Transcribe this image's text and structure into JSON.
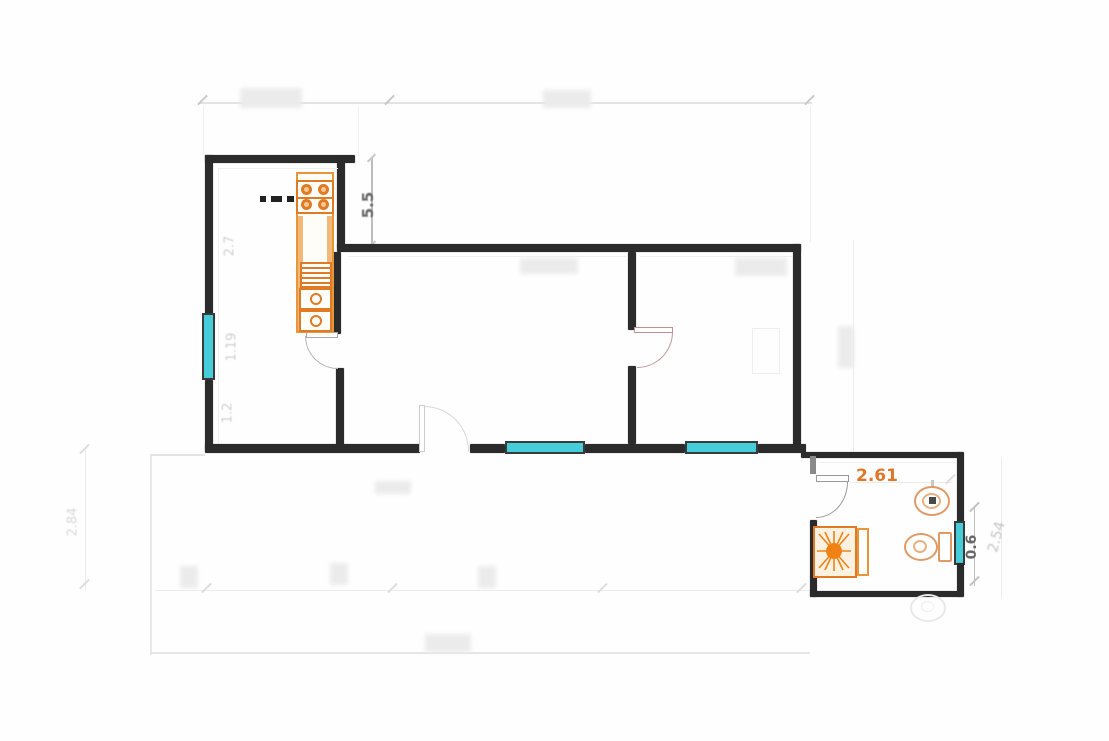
{
  "plan": {
    "type": "apartment-floor-plan",
    "dimension_labels": {
      "kitchen_height": "5.5",
      "kitchen_upper_width": "2.7",
      "kitchen_window_width": "1.19",
      "kitchen_lower_width": "1.2",
      "left_height": "2.84",
      "bathroom_width": "2.61",
      "bathroom_window_width": "0.6",
      "bathroom_height": "2.54"
    },
    "fixtures": [
      "stove",
      "kitchen-counter",
      "dish-rack",
      "double-sink",
      "shower",
      "toilet",
      "bidet",
      "washbasin"
    ],
    "colors": {
      "wall": "#2b2b2b",
      "fixture_orange": "#e07b24",
      "fixture_light": "#f2b877",
      "window_cyan": "#45cdd9",
      "dim_text_dark": "#666666",
      "dim_text_faint": "#cfcfcf",
      "faint_line": "#e3e3e3"
    }
  }
}
